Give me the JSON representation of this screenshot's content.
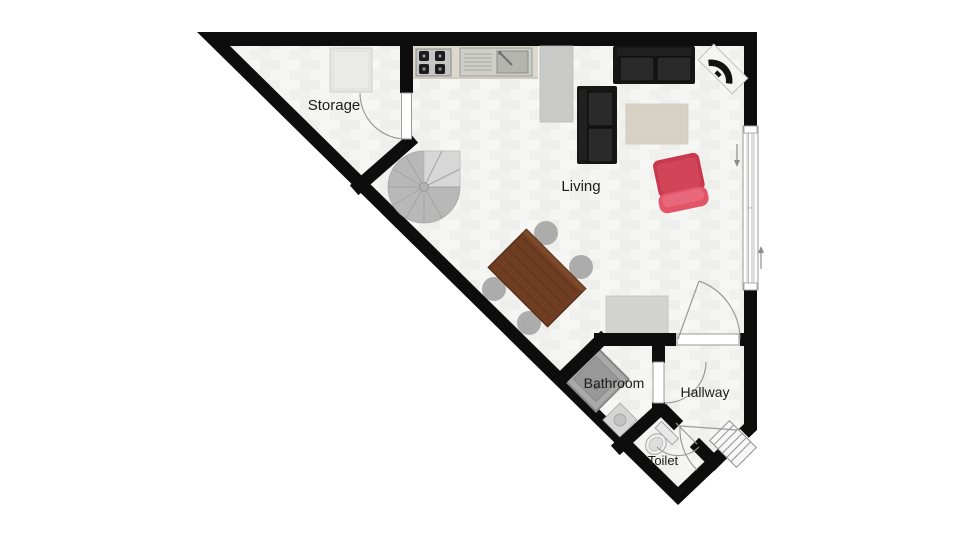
{
  "plan": {
    "type": "floor-plan",
    "rooms": [
      {
        "name": "storage",
        "label": "Storage"
      },
      {
        "name": "living",
        "label": "Living"
      },
      {
        "name": "bathroom",
        "label": "Bathroom"
      },
      {
        "name": "hallway",
        "label": "Hallway"
      },
      {
        "name": "toilet",
        "label": "Toilet"
      }
    ],
    "fixtures": [
      {
        "name": "sliding-window",
        "wall": "right",
        "arrows": [
          "down",
          "up"
        ]
      },
      {
        "name": "entry-door-with-steps",
        "wall": "bottom-right-diagonal"
      },
      {
        "name": "storage-door"
      },
      {
        "name": "living-hallway-door"
      },
      {
        "name": "bathroom-door"
      },
      {
        "name": "toilet-door"
      }
    ],
    "furniture": [
      {
        "name": "storage-shelf",
        "room": "storage"
      },
      {
        "name": "stove",
        "room": "living",
        "burners": 4
      },
      {
        "name": "kitchen-sink",
        "room": "living"
      },
      {
        "name": "kitchen-counter",
        "room": "living"
      },
      {
        "name": "tall-cabinet",
        "room": "living"
      },
      {
        "name": "sofa-two-seat-top",
        "room": "living"
      },
      {
        "name": "sofa-two-seat-side",
        "room": "living"
      },
      {
        "name": "tv-on-stand",
        "room": "living"
      },
      {
        "name": "rug",
        "room": "living"
      },
      {
        "name": "red-lounge-chair",
        "room": "living"
      },
      {
        "name": "spiral-staircase",
        "room": "living"
      },
      {
        "name": "dining-table",
        "room": "living",
        "chairs": 4
      },
      {
        "name": "sideboard",
        "room": "living"
      },
      {
        "name": "shower",
        "room": "bathroom"
      },
      {
        "name": "wash-basin",
        "room": "bathroom"
      },
      {
        "name": "toilet-fixture",
        "room": "toilet"
      }
    ],
    "colors": {
      "wall": "#0d0d0d",
      "floor": "#f2f2f0",
      "counter": "#dbd8cd",
      "sofa": "#161616",
      "rug": "#d8d2c5",
      "red_chair": "#cf4257",
      "table_wood": "#6f3d22",
      "fixture_gray": "#a9a9a9"
    }
  }
}
